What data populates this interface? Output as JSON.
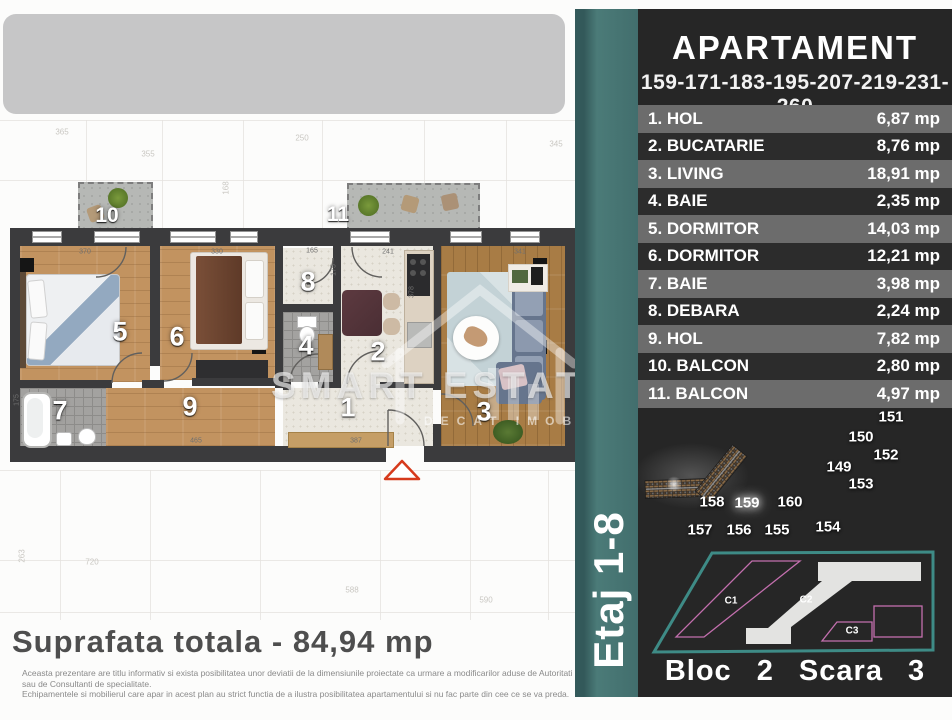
{
  "header": {
    "title": "APARTAMENT",
    "units": "159-171-183-195-207-219-231-260"
  },
  "rooms": [
    {
      "no": "1.",
      "name": "HOL",
      "area": "6,87 mp"
    },
    {
      "no": "2.",
      "name": "BUCATARIE",
      "area": "8,76 mp"
    },
    {
      "no": "3.",
      "name": "LIVING",
      "area": "18,91 mp"
    },
    {
      "no": "4.",
      "name": "BAIE",
      "area": "2,35 mp"
    },
    {
      "no": "5.",
      "name": "DORMITOR",
      "area": "14,03 mp"
    },
    {
      "no": "6.",
      "name": "DORMITOR",
      "area": "12,21 mp"
    },
    {
      "no": "7.",
      "name": "BAIE",
      "area": "3,98 mp"
    },
    {
      "no": "8.",
      "name": "DEBARA",
      "area": "2,24 mp"
    },
    {
      "no": "9.",
      "name": "HOL",
      "area": "7,82 mp"
    },
    {
      "no": "10.",
      "name": "BALCON",
      "area": "2,80 mp"
    },
    {
      "no": "11.",
      "name": "BALCON",
      "area": "4,97 mp"
    }
  ],
  "site_plan": {
    "highlighted_unit": "159",
    "labels": [
      {
        "t": "151",
        "x": 891,
        "y": 417
      },
      {
        "t": "150",
        "x": 861,
        "y": 437
      },
      {
        "t": "152",
        "x": 886,
        "y": 455
      },
      {
        "t": "149",
        "x": 839,
        "y": 467
      },
      {
        "t": "153",
        "x": 861,
        "y": 484
      },
      {
        "t": "158",
        "x": 712,
        "y": 502
      },
      {
        "t": "159",
        "x": 747,
        "y": 503
      },
      {
        "t": "160",
        "x": 790,
        "y": 502
      },
      {
        "t": "157",
        "x": 700,
        "y": 530
      },
      {
        "t": "156",
        "x": 739,
        "y": 530
      },
      {
        "t": "155",
        "x": 777,
        "y": 530
      },
      {
        "t": "154",
        "x": 828,
        "y": 527
      }
    ]
  },
  "block_diagram": {
    "c1": "C1",
    "c2": "C2",
    "c3": "C3",
    "caption": "Bloc 2 Scara 3"
  },
  "stripe": {
    "floor_label": "Etaj 1-8"
  },
  "plan": {
    "numbers": [
      {
        "t": "1",
        "x": 348,
        "y": 408
      },
      {
        "t": "2",
        "x": 378,
        "y": 352
      },
      {
        "t": "3",
        "x": 484,
        "y": 412
      },
      {
        "t": "4",
        "x": 306,
        "y": 346
      },
      {
        "t": "5",
        "x": 120,
        "y": 332
      },
      {
        "t": "6",
        "x": 177,
        "y": 337
      },
      {
        "t": "7",
        "x": 60,
        "y": 411
      },
      {
        "t": "8",
        "x": 308,
        "y": 282
      },
      {
        "t": "9",
        "x": 190,
        "y": 407
      },
      {
        "t": "10",
        "x": 107,
        "y": 216
      },
      {
        "t": "11",
        "x": 338,
        "y": 215
      }
    ],
    "dims": [
      {
        "t": "370",
        "x": 85,
        "y": 252
      },
      {
        "t": "330",
        "x": 217,
        "y": 252
      },
      {
        "t": "165",
        "x": 312,
        "y": 251
      },
      {
        "t": "241",
        "x": 388,
        "y": 252
      },
      {
        "t": "341",
        "x": 520,
        "y": 252
      },
      {
        "t": "465",
        "x": 196,
        "y": 441
      },
      {
        "t": "387",
        "x": 356,
        "y": 441
      },
      {
        "t": "175",
        "x": 334,
        "y": 270,
        "v": 1
      },
      {
        "t": "175",
        "x": 17,
        "y": 400,
        "v": 1
      },
      {
        "t": "378",
        "x": 412,
        "y": 292,
        "v": 1
      }
    ],
    "total": "Suprafata totala - 84,94 mp"
  },
  "watermark": {
    "brand": "SMART ESTATES",
    "tagline": "DECAT IMOBILIARE"
  },
  "disclaimer": {
    "line1": "Aceasta prezentare are titlu informativ si exista posibilitatea unor deviatii de la dimensiunile proiectate ca urmare a modificarilor aduse de Autoritati sau de Consultanti de specialitate.",
    "line2": "Echipamentele si mobilierul care apar in acest plan au strict functia de a ilustra posibilitatea apartamentului si nu fac parte din cee ce se va preda."
  },
  "background": {
    "faint_dims": [
      {
        "t": "355",
        "x": 148,
        "y": 154
      },
      {
        "t": "168",
        "x": 226,
        "y": 188,
        "v": 1
      },
      {
        "t": "345",
        "x": 556,
        "y": 144
      },
      {
        "t": "365",
        "x": 62,
        "y": 132
      },
      {
        "t": "355",
        "x": 38,
        "y": 302,
        "v": 1
      },
      {
        "t": "250",
        "x": 302,
        "y": 138
      },
      {
        "t": "590",
        "x": 486,
        "y": 600
      },
      {
        "t": "720",
        "x": 92,
        "y": 562
      },
      {
        "t": "263",
        "x": 22,
        "y": 556,
        "v": 1
      },
      {
        "t": "588",
        "x": 352,
        "y": 590
      }
    ]
  },
  "colors": {
    "teal": "#44716F",
    "panel": "#262626",
    "row_light": "#6C6C6C",
    "row_dark": "#2C2C2C",
    "wall": "#3B3B3D",
    "accent_red": "#D63A1C",
    "pink_outline": "#C36FAE",
    "highlight": "#FFFFFF"
  }
}
